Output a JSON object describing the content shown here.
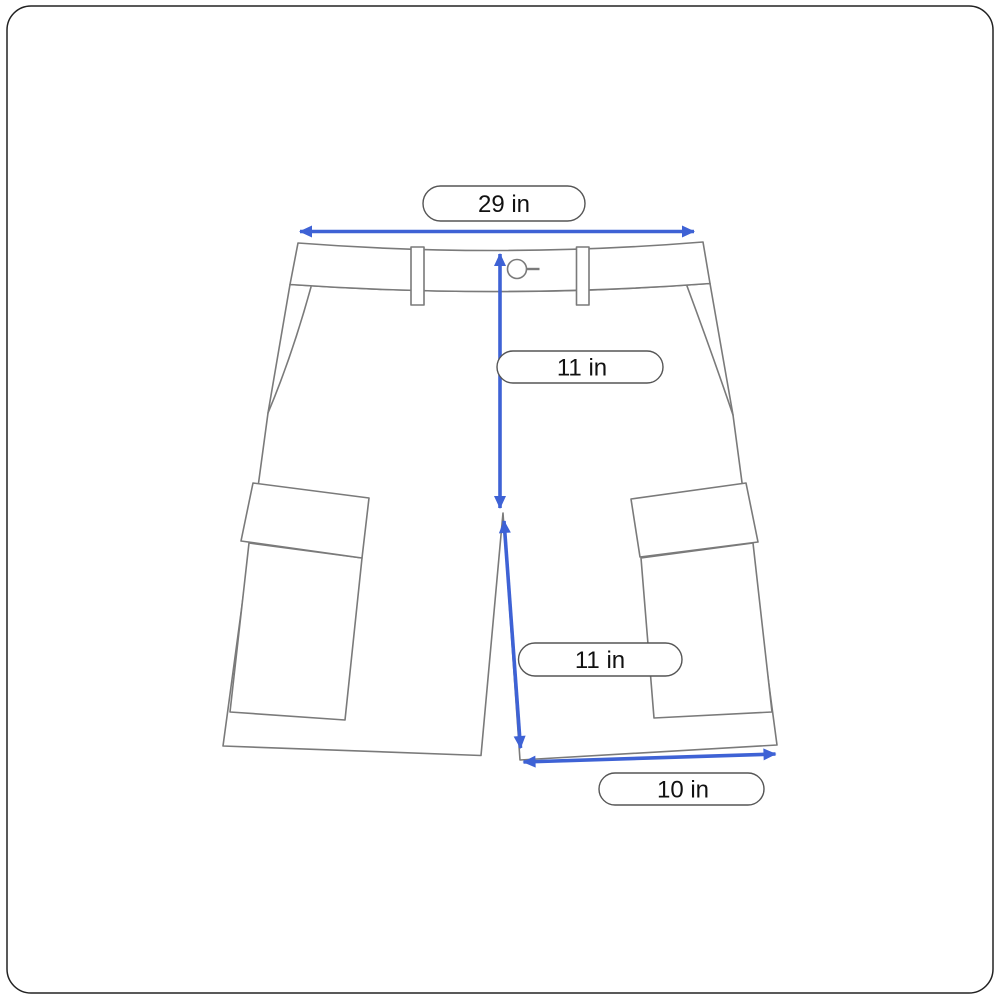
{
  "measurements": {
    "waist": {
      "value": "29 in"
    },
    "front_rise": {
      "value": "11 in"
    },
    "inseam": {
      "value": "11 in"
    },
    "leg_opening": {
      "value": "10 in"
    }
  },
  "colors": {
    "arrow_blue": "#3E62D5",
    "outline_gray": "#7a7a7a",
    "pill_border_gray": "#555555",
    "frame_border": "#222222",
    "text_black": "#111111",
    "background": "#ffffff"
  }
}
